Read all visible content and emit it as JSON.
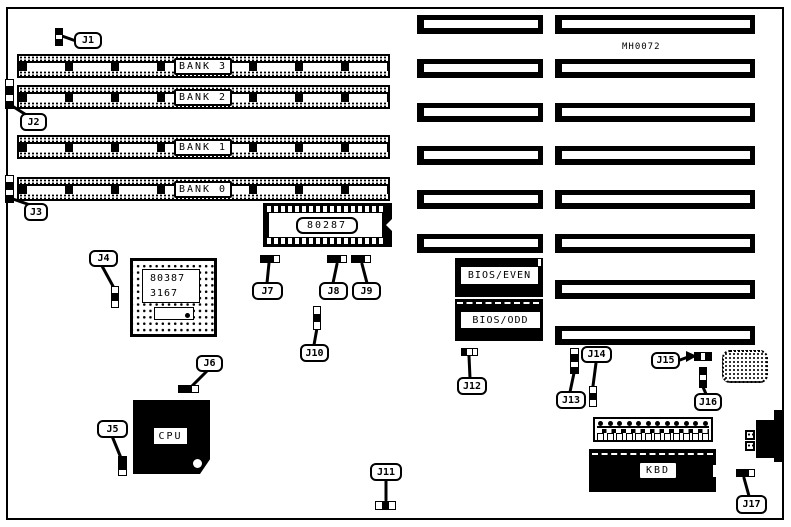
{
  "diagram": {
    "part_number": "MH0072",
    "banks": [
      "BANK 3",
      "BANK 2",
      "BANK 1",
      "BANK 0"
    ],
    "jumpers": [
      "J1",
      "J2",
      "J3",
      "J4",
      "J5",
      "J6",
      "J7",
      "J8",
      "J9",
      "J10",
      "J11",
      "J12",
      "J13",
      "J14",
      "J15",
      "J16",
      "J17"
    ],
    "chips": {
      "coprocessor_287": "80287",
      "coprocessor_387_line1": "80387",
      "coprocessor_387_line2": "3167",
      "cpu": "CPU",
      "bios_even": "BIOS/EVEN",
      "bios_odd": "BIOS/ODD",
      "keyboard_controller": "KBD"
    }
  }
}
